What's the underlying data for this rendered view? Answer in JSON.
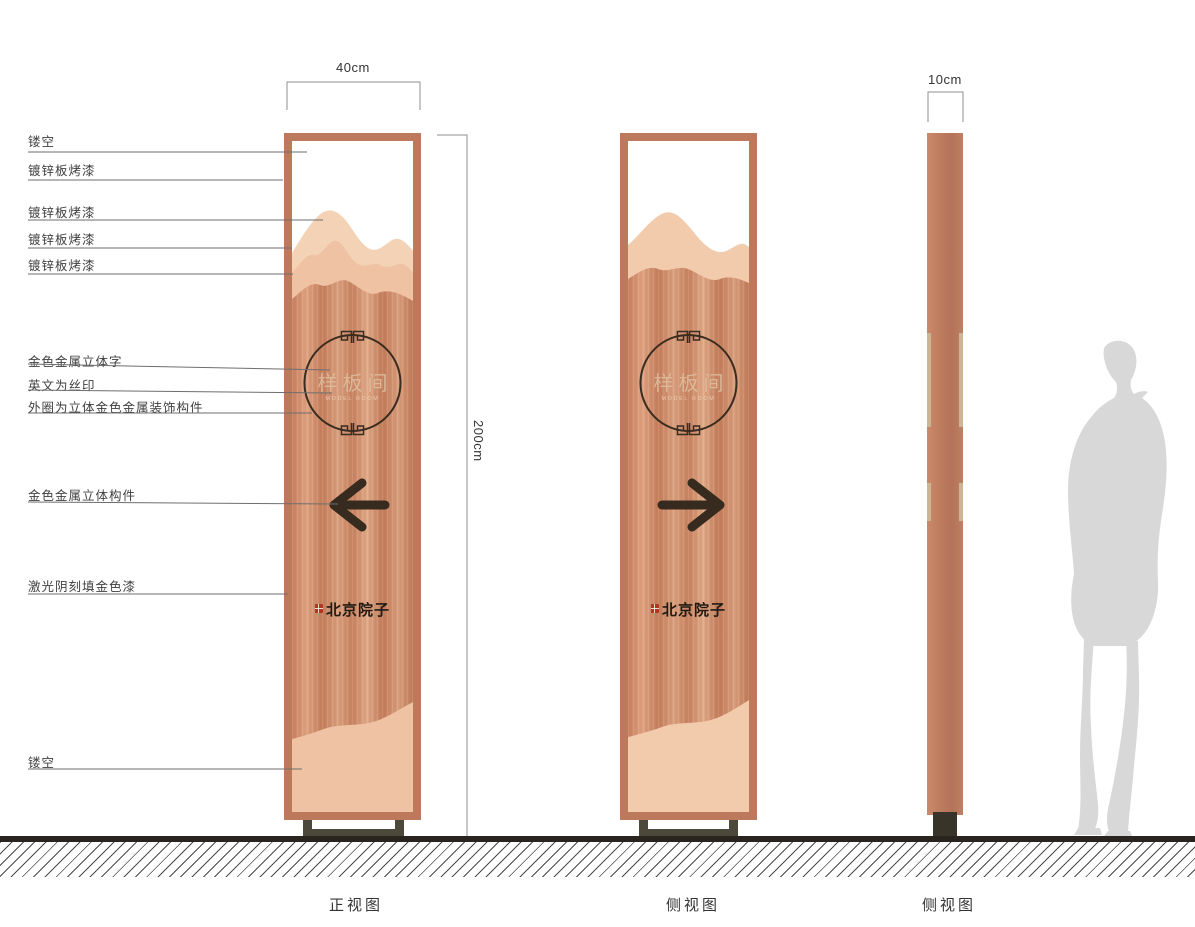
{
  "document": {
    "type": "signage-construction-drawing",
    "background": "#ffffff"
  },
  "annotations": {
    "items": [
      {
        "text": "镂空"
      },
      {
        "text": "镀锌板烤漆"
      },
      {
        "text": "镀锌板烤漆"
      },
      {
        "text": "镀锌板烤漆"
      },
      {
        "text": "镀锌板烤漆"
      },
      {
        "text": "金色金属立体字"
      },
      {
        "text": "英文为丝印"
      },
      {
        "text": "外圈为立体金色金属装饰构件"
      },
      {
        "text": "金色金属立体构件"
      },
      {
        "text": "激光阴刻填金色漆"
      },
      {
        "text": "镂空"
      }
    ]
  },
  "dims": {
    "front_width": "40cm",
    "side_width": "10cm",
    "height": "200cm"
  },
  "captions": {
    "front": "正视图",
    "side": "侧视图",
    "side_edge": "侧视图"
  },
  "sign": {
    "plaque": "样板间",
    "plaque_en": "MODEL ROOM",
    "brand": "北京院子"
  },
  "colors": {
    "copper_frame": "#bc795b",
    "panel_copper": "#c8825f",
    "mountain_back": "#f4d2b6",
    "mountain_mid": "#eec2a2",
    "gold_strip": "#cdb493",
    "arrow_dark": "#372b1f",
    "seal_red": "#b23524",
    "foot_gray": "#4d493a",
    "silhouette_gray": "#d8d8d8"
  }
}
